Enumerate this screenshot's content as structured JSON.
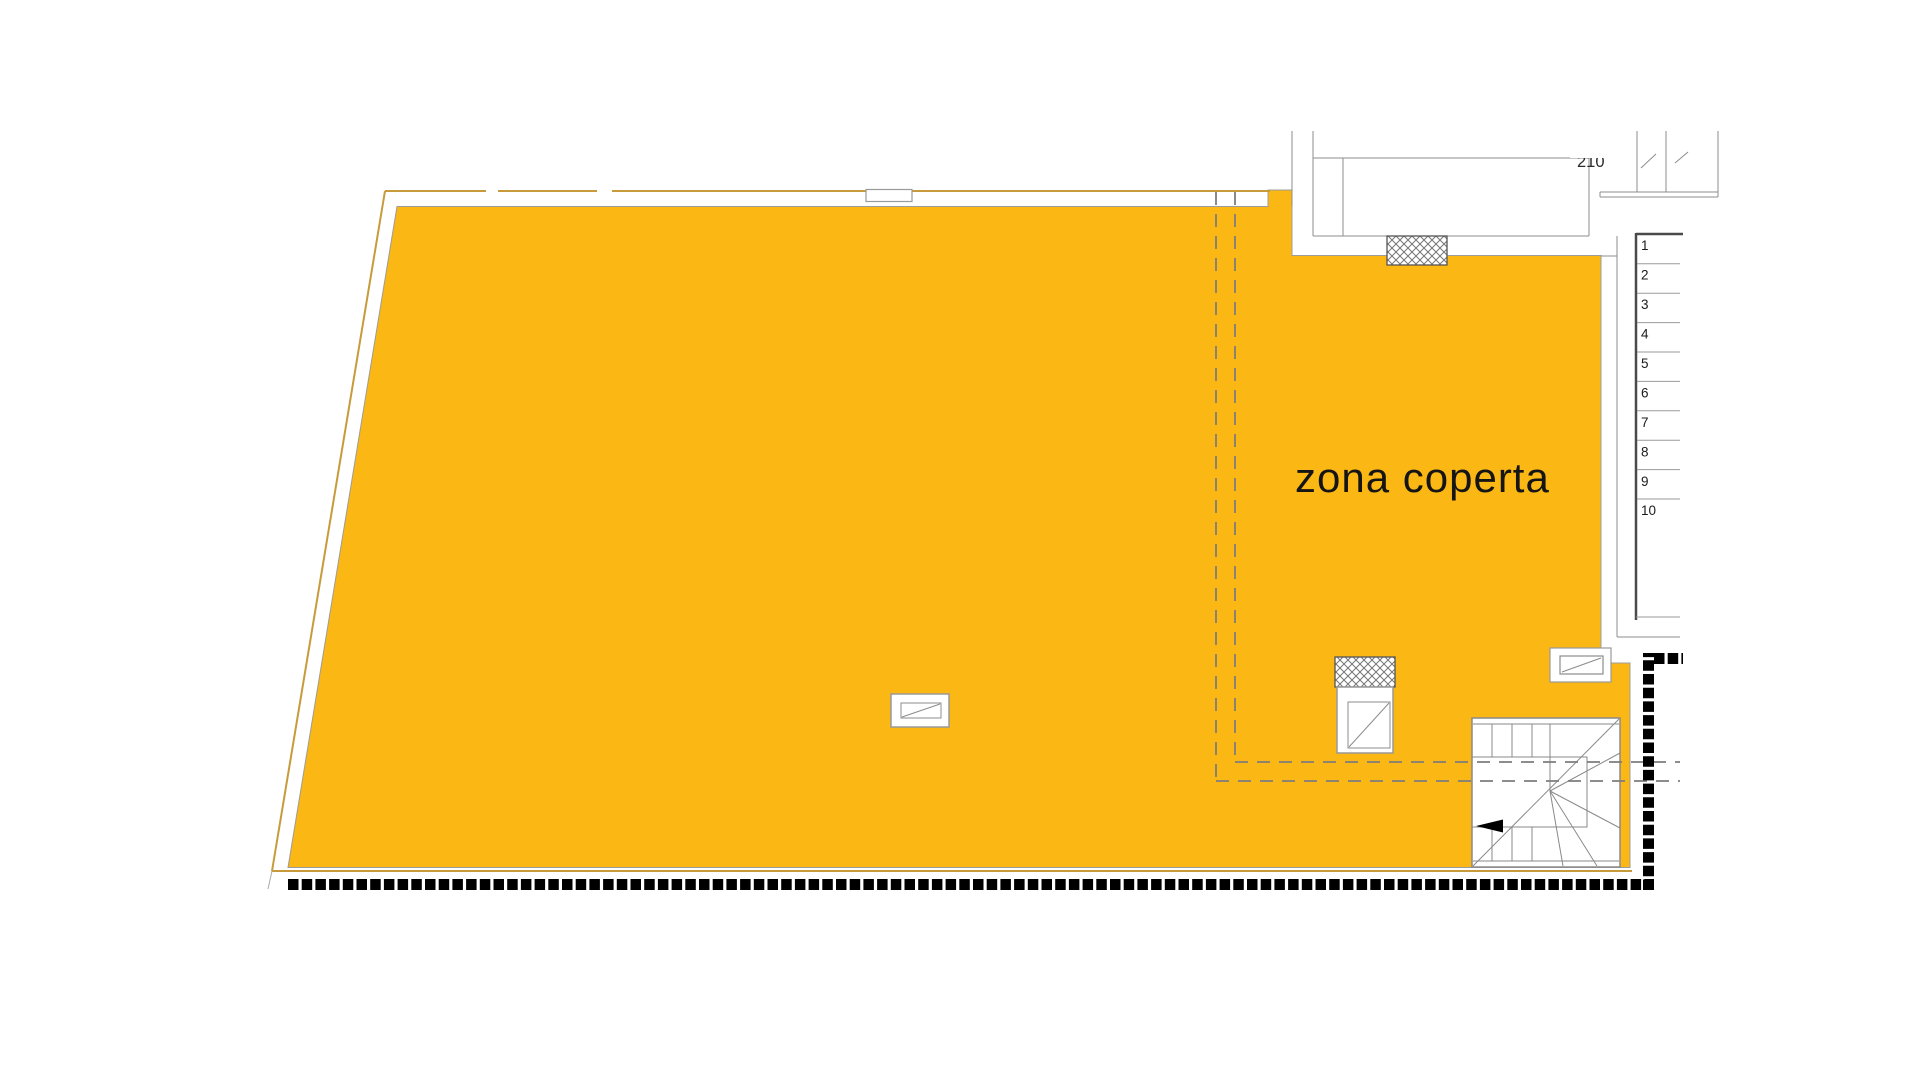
{
  "drawing": {
    "zone_label": "zona coperta",
    "dimension_label": "210",
    "step_numbers": [
      "1",
      "2",
      "3",
      "4",
      "5",
      "6",
      "7",
      "8",
      "9",
      "10"
    ],
    "colors": {
      "terrace_fill": "#FBB713",
      "perimeter_outline": "#C79B3B",
      "cad_line_gray": "#8C8C8C",
      "dashed_zone_gray": "#7D7D7D",
      "site_border_black": "#000000",
      "text_color": "#151515"
    }
  }
}
